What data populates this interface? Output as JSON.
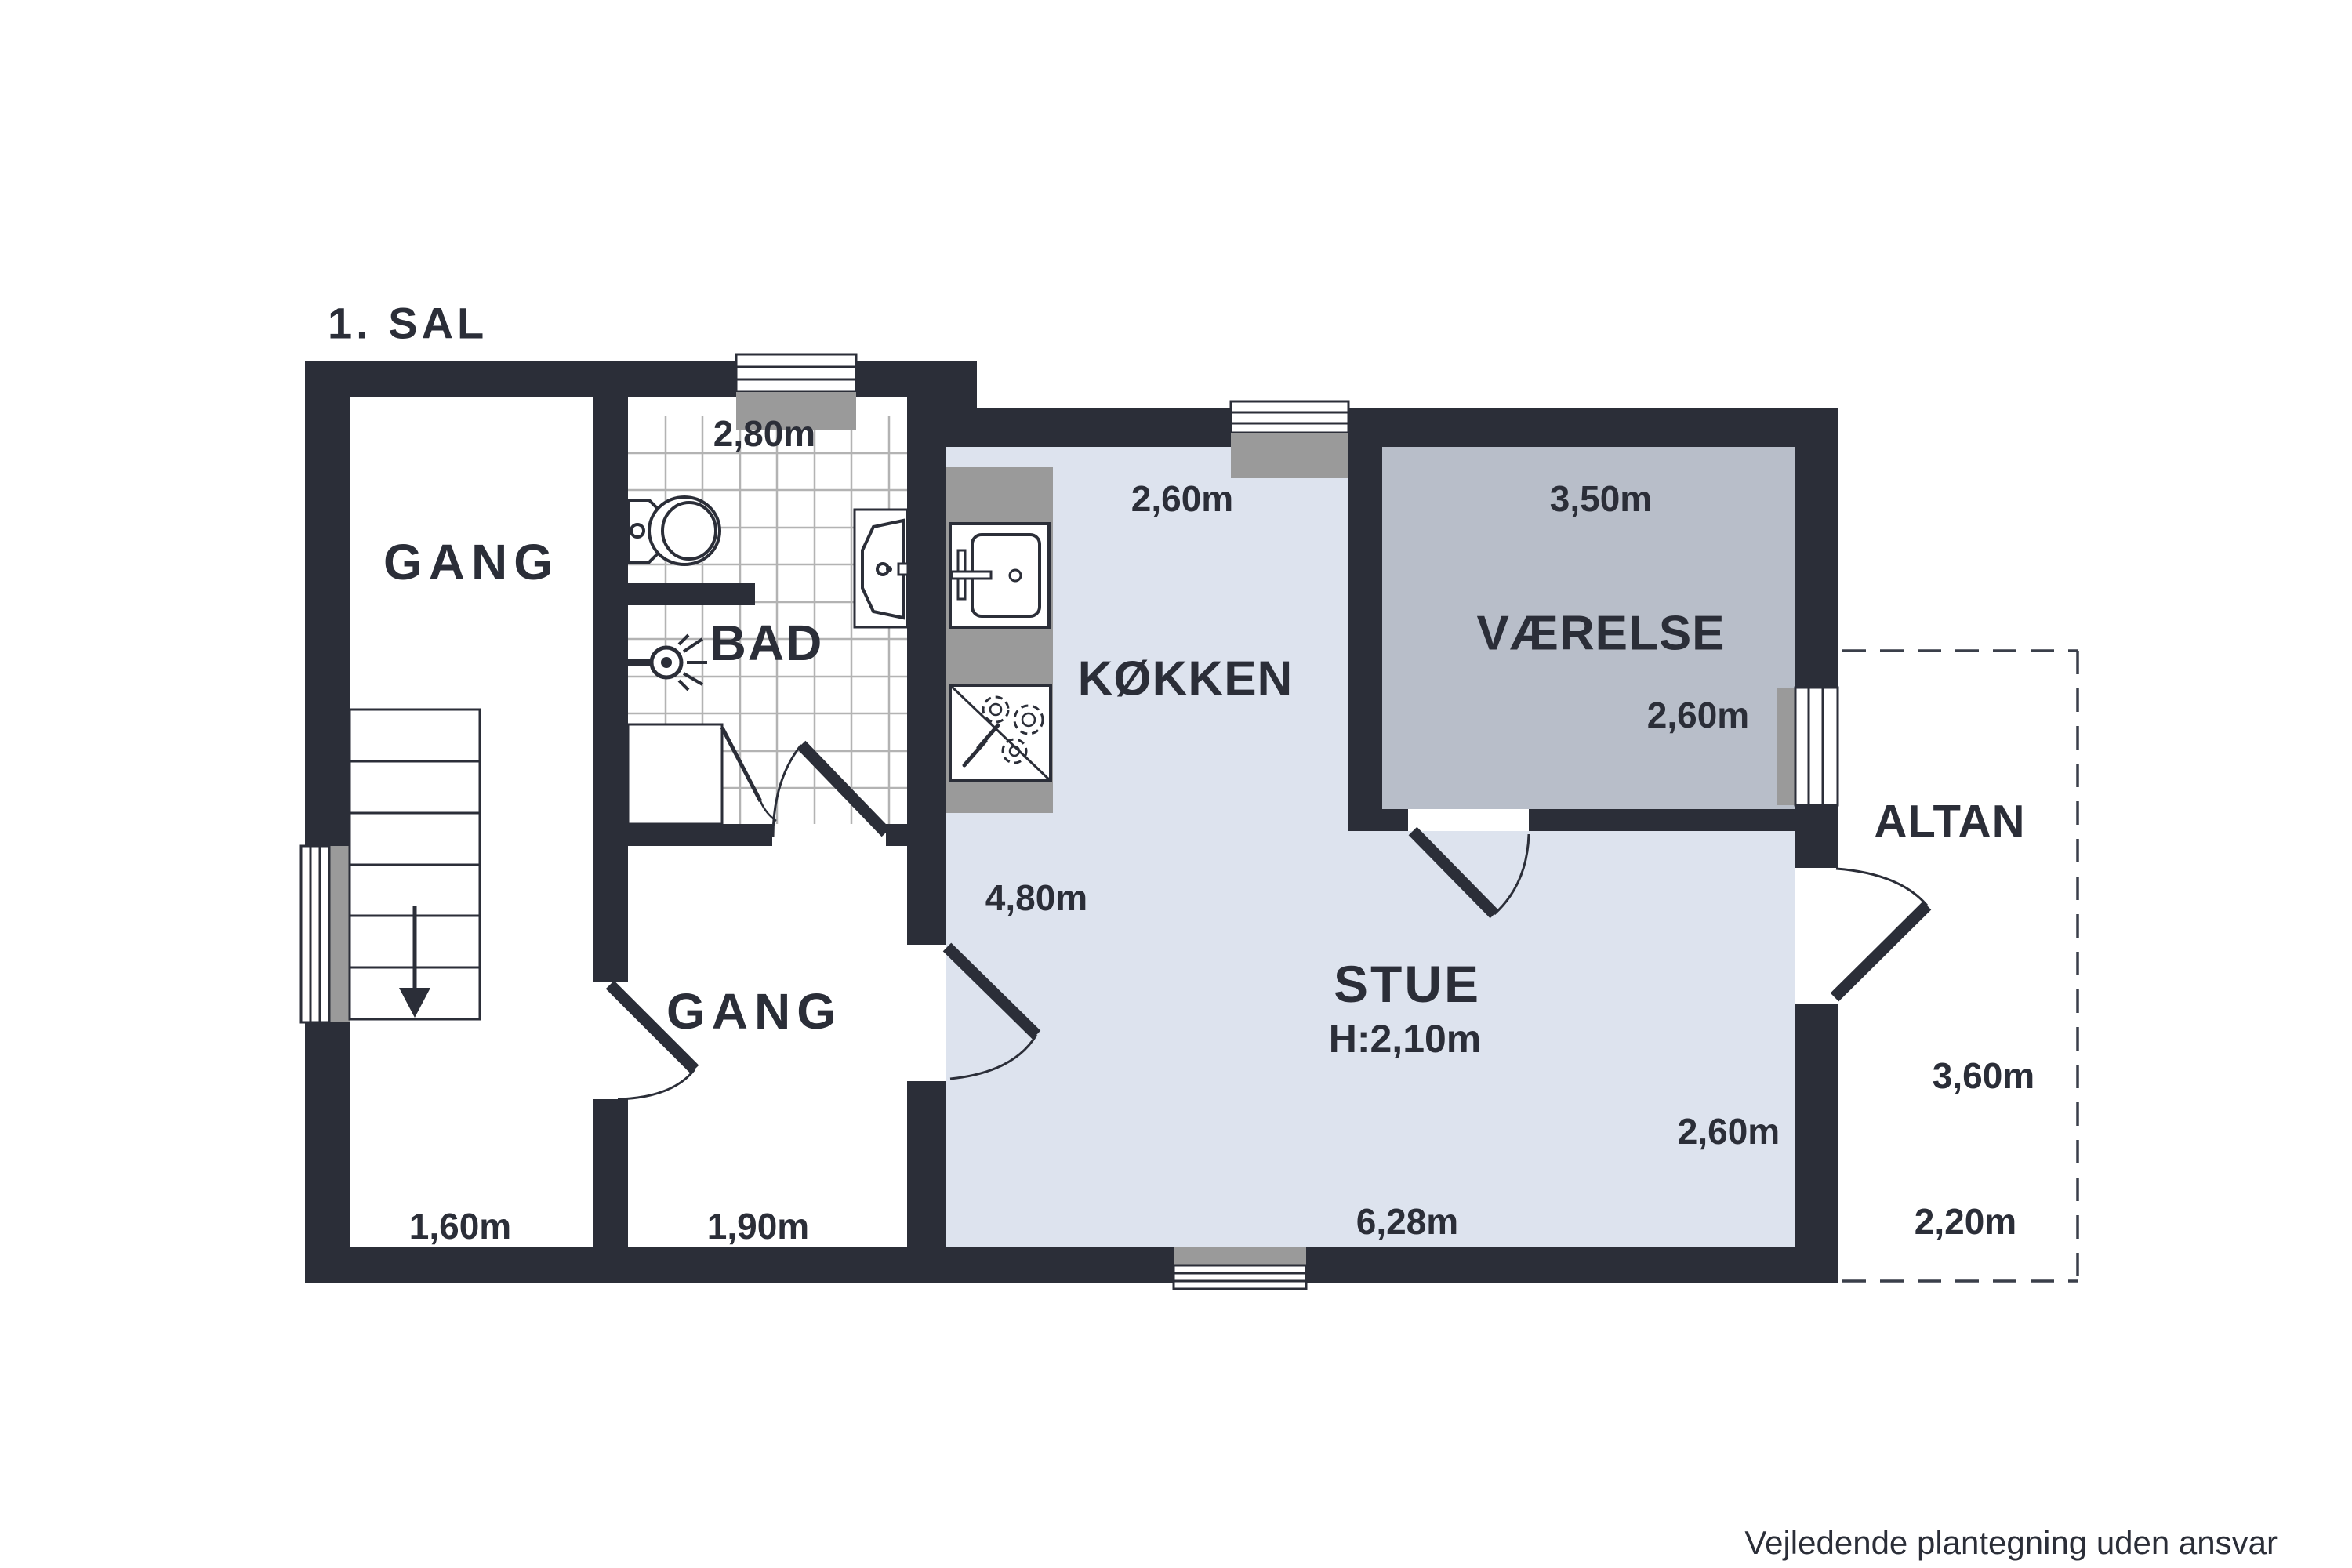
{
  "title": "1. SAL",
  "disclaimer": "Vejledende plantegning uden ansvar",
  "colors": {
    "wall": "#2b2e38",
    "floor_light": "#dde3ee",
    "floor_room": "#b8bec9",
    "sill_gray": "#9a9a9a",
    "tile_line": "#b3b3b3",
    "text": "#2b2e38",
    "background": "#ffffff"
  },
  "rooms": [
    {
      "id": "gang-left",
      "label": "GANG",
      "width_label": "1,60m"
    },
    {
      "id": "bad",
      "label": "BAD",
      "width_label": "2,80m"
    },
    {
      "id": "gang-mid",
      "label": "GANG",
      "width_label": "1,90m"
    },
    {
      "id": "kokken",
      "label": "KØKKEN",
      "width_label": "2,60m",
      "depth_label": "4,80m"
    },
    {
      "id": "vaerelse",
      "label": "VÆRELSE",
      "width_label": "3,50m",
      "depth_label": "2,60m"
    },
    {
      "id": "stue",
      "label": "STUE",
      "ceiling_height_label": "H:2,10m",
      "width_label": "6,28m",
      "depth_label": "2,60m"
    },
    {
      "id": "altan",
      "label": "ALTAN",
      "depth_label": "3,60m",
      "width_label": "2,20m"
    }
  ],
  "fixtures": [
    "stairs-down-arrow",
    "toilet",
    "bathroom-vanity-sink",
    "shower-head",
    "shower-tray",
    "kitchen-counter",
    "kitchen-sink",
    "stove-with-burners",
    "windows",
    "door-swings",
    "balcony-dashed-outline"
  ]
}
